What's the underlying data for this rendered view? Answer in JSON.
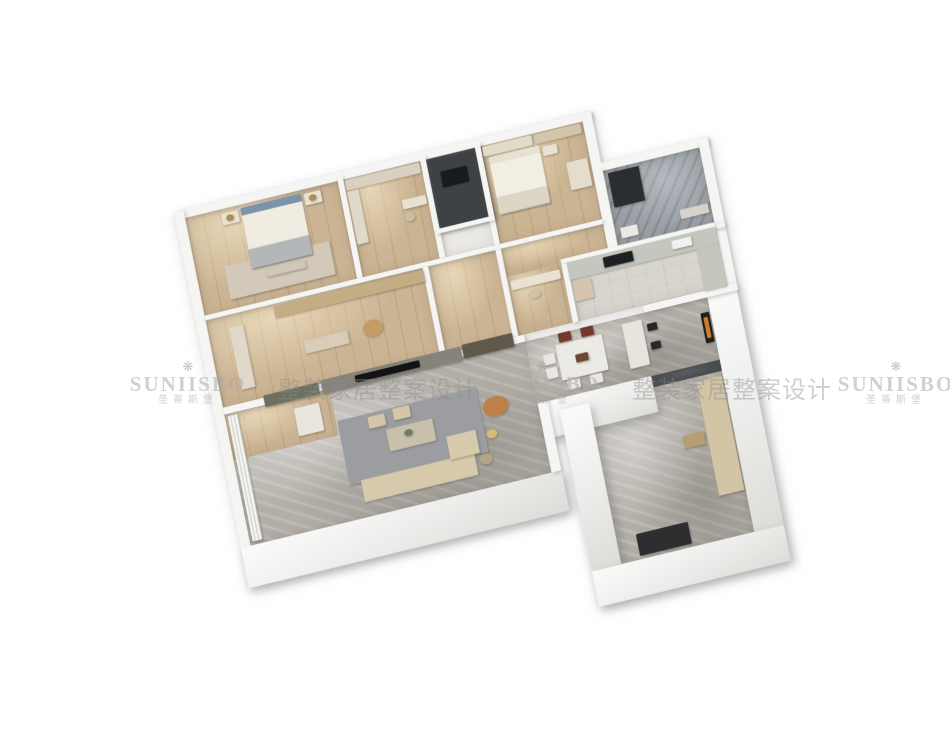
{
  "canvas": {
    "width": 950,
    "height": 733,
    "background": "#ffffff"
  },
  "watermark": {
    "flower_icon": "❋",
    "brand": "SUNIISBO",
    "brand_cn": "圣蒂斯堡",
    "tagline": "整装家居整案设计",
    "tiles": [
      {
        "x": 128,
        "y": 360
      },
      {
        "x": 482,
        "y": 360
      },
      {
        "x": 836,
        "y": 360
      }
    ]
  },
  "plan": {
    "floors": [
      {
        "id": "master-bedroom-floor",
        "x": 0,
        "y": 0,
        "w": 218,
        "h": 170,
        "tex": "wood"
      },
      {
        "id": "dressing-room-floor",
        "x": 226,
        "y": 0,
        "w": 110,
        "h": 170,
        "tex": "wood"
      },
      {
        "id": "utility-room-floor",
        "x": 344,
        "y": 0,
        "w": 70,
        "h": 120,
        "tex": "dark"
      },
      {
        "id": "utility-south-closet-floor",
        "x": 344,
        "y": 128,
        "w": 70,
        "h": 42,
        "tex": "plain"
      },
      {
        "id": "bedroom2-floor",
        "x": 422,
        "y": 0,
        "w": 146,
        "h": 170,
        "tex": "wood"
      },
      {
        "id": "bathroom-floor",
        "x": 582,
        "y": 90,
        "w": 138,
        "h": 134,
        "tex": "stone"
      },
      {
        "id": "study-floor",
        "x": 0,
        "y": 178,
        "w": 310,
        "h": 152,
        "tex": "wood"
      },
      {
        "id": "hallway-floor",
        "x": 318,
        "y": 178,
        "w": 104,
        "h": 152,
        "tex": "wood"
      },
      {
        "id": "hallway-east-floor",
        "x": 422,
        "y": 178,
        "w": 146,
        "h": 50,
        "tex": "wood"
      },
      {
        "id": "desk-nook-floor",
        "x": 422,
        "y": 228,
        "w": 78,
        "h": 102,
        "tex": "wood"
      },
      {
        "id": "kitchen-floor",
        "x": 508,
        "y": 228,
        "w": 212,
        "h": 102,
        "tex": "tile"
      },
      {
        "id": "living-room-floor",
        "x": 0,
        "y": 342,
        "w": 430,
        "h": 228,
        "tex": "marble"
      },
      {
        "id": "living-wood-corner-floor",
        "x": 0,
        "y": 342,
        "w": 150,
        "h": 80,
        "tex": "wood"
      },
      {
        "id": "dining-room-floor",
        "x": 430,
        "y": 342,
        "w": 260,
        "h": 108,
        "tex": "marble"
      },
      {
        "id": "passage-floor",
        "x": 590,
        "y": 450,
        "w": 100,
        "h": 20,
        "tex": "dark"
      },
      {
        "id": "entry-hall-floor",
        "x": 500,
        "y": 470,
        "w": 190,
        "h": 280,
        "tex": "marble"
      }
    ],
    "walls": [
      {
        "id": "wall-utility-backdrop",
        "x": 338,
        "y": -8,
        "w": 84,
        "h": 134,
        "kind": "darkwall"
      },
      {
        "id": "wall-north",
        "x": -14,
        "y": -14,
        "w": 596,
        "h": 14,
        "kind": "out"
      },
      {
        "id": "wall-west",
        "x": -14,
        "y": -14,
        "w": 14,
        "h": 598,
        "kind": "out"
      },
      {
        "id": "wall-south-living",
        "x": -14,
        "y": 570,
        "w": 458,
        "h": 70,
        "kind": "face"
      },
      {
        "id": "wall-bedroom2-east-step",
        "x": 568,
        "y": -14,
        "w": 14,
        "h": 100,
        "kind": "out"
      },
      {
        "id": "wall-bathroom-north",
        "x": 568,
        "y": 76,
        "w": 166,
        "h": 14,
        "kind": "out"
      },
      {
        "id": "wall-bathroom-east",
        "x": 720,
        "y": 76,
        "w": 14,
        "h": 162,
        "kind": "out"
      },
      {
        "id": "wall-kitchen-east",
        "x": 720,
        "y": 238,
        "w": 14,
        "h": 92,
        "kind": "out"
      },
      {
        "id": "wall-dining-east",
        "x": 690,
        "y": 330,
        "w": 42,
        "h": 420,
        "kind": "face"
      },
      {
        "id": "wall-dining-south",
        "x": 430,
        "y": 450,
        "w": 162,
        "h": 62,
        "kind": "face"
      },
      {
        "id": "wall-living-east",
        "x": 430,
        "y": 450,
        "w": 14,
        "h": 120,
        "kind": "out"
      },
      {
        "id": "wall-entry-west",
        "x": 458,
        "y": 470,
        "w": 42,
        "h": 280,
        "kind": "face"
      },
      {
        "id": "wall-entry-south",
        "x": 458,
        "y": 750,
        "w": 274,
        "h": 62,
        "kind": "face"
      },
      {
        "id": "wall-master-dressing",
        "x": 218,
        "y": -8,
        "w": 8,
        "h": 178,
        "kind": "in"
      },
      {
        "id": "wall-dressing-utility",
        "x": 336,
        "y": -8,
        "w": 8,
        "h": 178,
        "kind": "in"
      },
      {
        "id": "wall-utility-bedroom2",
        "x": 414,
        "y": -8,
        "w": 8,
        "h": 178,
        "kind": "in"
      },
      {
        "id": "wall-bedroom2-bath",
        "x": 568,
        "y": 86,
        "w": 14,
        "h": 146,
        "kind": "in"
      },
      {
        "id": "wall-topband-south",
        "x": 0,
        "y": 170,
        "w": 568,
        "h": 8,
        "kind": "in"
      },
      {
        "id": "wall-bathroom-south",
        "x": 568,
        "y": 224,
        "w": 166,
        "h": 8,
        "kind": "in"
      },
      {
        "id": "wall-study-east",
        "x": 310,
        "y": 178,
        "w": 8,
        "h": 152,
        "kind": "in"
      },
      {
        "id": "wall-nook-west",
        "x": 414,
        "y": 178,
        "w": 8,
        "h": 152,
        "kind": "in"
      },
      {
        "id": "wall-kitchen-north",
        "x": 500,
        "y": 220,
        "w": 220,
        "h": 8,
        "kind": "in"
      },
      {
        "id": "wall-nook-kitchen",
        "x": 500,
        "y": 228,
        "w": 8,
        "h": 102,
        "kind": "in"
      },
      {
        "id": "wall-tv",
        "x": 0,
        "y": 330,
        "w": 430,
        "h": 12,
        "kind": "in"
      },
      {
        "id": "wall-kitchen-south",
        "x": 600,
        "y": 330,
        "w": 134,
        "h": 12,
        "kind": "in"
      },
      {
        "id": "wall-utility-south",
        "x": 338,
        "y": 120,
        "w": 84,
        "h": 8,
        "kind": "in"
      }
    ],
    "furniture": [
      {
        "id": "master-rug",
        "x": 40,
        "y": 96,
        "w": 150,
        "h": 58,
        "c": "#d2c9b9"
      },
      {
        "id": "master-bed-headboard",
        "x": 78,
        "y": 6,
        "w": 86,
        "h": 13,
        "c": "#7b93ae"
      },
      {
        "id": "master-bed",
        "x": 78,
        "y": 19,
        "w": 86,
        "h": 92,
        "c": "#f0ece1"
      },
      {
        "id": "master-bed-throw",
        "x": 78,
        "y": 78,
        "w": 86,
        "h": 33,
        "c": "#b4b7ba"
      },
      {
        "id": "master-nightstand-left",
        "x": 50,
        "y": 8,
        "w": 24,
        "h": 20,
        "c": "#eae3d2"
      },
      {
        "id": "master-nightstand-right",
        "x": 168,
        "y": 8,
        "w": 24,
        "h": 20,
        "c": "#eae3d2"
      },
      {
        "id": "master-lamp-left",
        "x": 56,
        "y": 12,
        "w": 11,
        "h": 11,
        "c": "#b08d4f",
        "r": 1
      },
      {
        "id": "master-lamp-right",
        "x": 174,
        "y": 12,
        "w": 11,
        "h": 11,
        "c": "#b08d4f",
        "r": 1
      },
      {
        "id": "master-bench",
        "x": 96,
        "y": 118,
        "w": 56,
        "h": 13,
        "c": "#cfc8b8"
      },
      {
        "id": "dressing-closet-north",
        "x": 228,
        "y": 2,
        "w": 106,
        "h": 18,
        "c": "#d8d1c0"
      },
      {
        "id": "dressing-closet-west",
        "x": 228,
        "y": 22,
        "w": 16,
        "h": 92,
        "c": "#e0d9c8"
      },
      {
        "id": "dressing-vanity",
        "x": 300,
        "y": 58,
        "w": 34,
        "h": 16,
        "c": "#e8e1d1"
      },
      {
        "id": "dressing-stool",
        "x": 300,
        "y": 82,
        "w": 14,
        "h": 14,
        "c": "#cbbfa8",
        "r": 1
      },
      {
        "id": "utility-window-frame",
        "x": 360,
        "y": 26,
        "w": 38,
        "h": 28,
        "c": "#191b1d"
      },
      {
        "id": "bedroom2-wardrobe",
        "x": 424,
        "y": 2,
        "w": 70,
        "h": 17,
        "c": "#e2dbc9"
      },
      {
        "id": "bedroom2-bookshelf",
        "x": 498,
        "y": 2,
        "w": 66,
        "h": 17,
        "c": "#d2c5aa"
      },
      {
        "id": "bedroom2-headboard",
        "x": 430,
        "y": 22,
        "w": 72,
        "h": 12,
        "c": "#e7e1d2"
      },
      {
        "id": "bedroom2-bed",
        "x": 430,
        "y": 34,
        "w": 72,
        "h": 88,
        "c": "#f1eee4"
      },
      {
        "id": "bedroom2-throw",
        "x": 430,
        "y": 92,
        "w": 72,
        "h": 28,
        "c": "#dcd6c7"
      },
      {
        "id": "bedroom2-desk",
        "x": 534,
        "y": 62,
        "w": 30,
        "h": 48,
        "c": "#e4ddcb"
      },
      {
        "id": "bedroom2-nightstand",
        "x": 506,
        "y": 26,
        "w": 20,
        "h": 16,
        "c": "#eae3d3"
      },
      {
        "id": "bathroom-shower",
        "x": 588,
        "y": 96,
        "w": 44,
        "h": 60,
        "c": "#2b2e31"
      },
      {
        "id": "bathroom-vanity",
        "x": 676,
        "y": 186,
        "w": 40,
        "h": 16,
        "c": "#d7d3cb"
      },
      {
        "id": "bathroom-wc",
        "x": 590,
        "y": 192,
        "w": 24,
        "h": 18,
        "c": "#ebe9e5"
      },
      {
        "id": "study-wardrobe",
        "x": 30,
        "y": 200,
        "w": 20,
        "h": 108,
        "c": "#e0d9c9"
      },
      {
        "id": "study-bookshelf",
        "x": 96,
        "y": 182,
        "w": 214,
        "h": 20,
        "c": "#c3ad85"
      },
      {
        "id": "study-armchair",
        "x": 212,
        "y": 244,
        "w": 28,
        "h": 28,
        "c": "#c59b66",
        "r": 1
      },
      {
        "id": "study-desk",
        "x": 128,
        "y": 252,
        "w": 62,
        "h": 22,
        "c": "#d7cdb8"
      },
      {
        "id": "nook-desk",
        "x": 426,
        "y": 236,
        "w": 70,
        "h": 16,
        "c": "#e9e2d2"
      },
      {
        "id": "nook-chair",
        "x": 448,
        "y": 258,
        "w": 16,
        "h": 16,
        "c": "#cfc3ab",
        "r": 1
      },
      {
        "id": "kitchen-counter-north",
        "x": 508,
        "y": 228,
        "w": 212,
        "h": 30,
        "c": "#c3c7bd"
      },
      {
        "id": "kitchen-cooktop",
        "x": 558,
        "y": 234,
        "w": 42,
        "h": 18,
        "c": "#1e2022"
      },
      {
        "id": "kitchen-sink",
        "x": 656,
        "y": 234,
        "w": 28,
        "h": 15,
        "c": "#f0f1ef"
      },
      {
        "id": "kitchen-counter-east",
        "x": 688,
        "y": 258,
        "w": 32,
        "h": 72,
        "c": "#c3c7bd"
      },
      {
        "id": "kitchen-fridge",
        "x": 510,
        "y": 262,
        "w": 26,
        "h": 34,
        "c": "#d6c4ae"
      },
      {
        "id": "tv-marble-panel",
        "x": 140,
        "y": 324,
        "w": 200,
        "h": 24,
        "c": "#87837b"
      },
      {
        "id": "tv-screen",
        "x": 188,
        "y": 330,
        "w": 92,
        "h": 12,
        "c": "#111315"
      },
      {
        "id": "tv-cabinet-left",
        "x": 58,
        "y": 326,
        "w": 78,
        "h": 20,
        "c": "#6d7060"
      },
      {
        "id": "tv-shelf-right",
        "x": 342,
        "y": 322,
        "w": 72,
        "h": 24,
        "c": "#5f594c"
      },
      {
        "id": "living-curtain",
        "x": 4,
        "y": 346,
        "w": 14,
        "h": 218,
        "c": "",
        "tex": "curtain"
      },
      {
        "id": "living-rug",
        "x": 152,
        "y": 398,
        "w": 198,
        "h": 112,
        "c": "#9b9da0"
      },
      {
        "id": "living-sofa",
        "x": 168,
        "y": 506,
        "w": 162,
        "h": 38,
        "c": "#d6c9ac"
      },
      {
        "id": "living-chaise",
        "x": 296,
        "y": 468,
        "w": 42,
        "h": 40,
        "c": "#d6c9ac"
      },
      {
        "id": "living-coffee-table",
        "x": 216,
        "y": 432,
        "w": 66,
        "h": 38,
        "c": "#c9c0ab"
      },
      {
        "id": "living-table-plant",
        "x": 240,
        "y": 440,
        "w": 12,
        "h": 12,
        "c": "#6f7f5e",
        "r": 1
      },
      {
        "id": "living-ottoman-a",
        "x": 194,
        "y": 404,
        "w": 24,
        "h": 20,
        "c": "#d4c6a7"
      },
      {
        "id": "living-ottoman-b",
        "x": 230,
        "y": 400,
        "w": 24,
        "h": 20,
        "c": "#d4c6a7"
      },
      {
        "id": "living-leather-armchair",
        "x": 354,
        "y": 420,
        "w": 36,
        "h": 34,
        "c": "#bc8148",
        "r": 1
      },
      {
        "id": "living-floor-lamp",
        "x": 352,
        "y": 474,
        "w": 15,
        "h": 15,
        "c": "#d8b978",
        "r": 1
      },
      {
        "id": "living-side-table",
        "x": 336,
        "y": 512,
        "w": 18,
        "h": 18,
        "c": "#b5a586",
        "r": 1
      },
      {
        "id": "living-cabinet-nw",
        "x": 96,
        "y": 360,
        "w": 36,
        "h": 48,
        "c": "#e9e6de"
      },
      {
        "id": "dining-table",
        "x": 470,
        "y": 360,
        "w": 66,
        "h": 62,
        "c": "#eceae4"
      },
      {
        "id": "dining-table-decor",
        "x": 494,
        "y": 384,
        "w": 18,
        "h": 14,
        "c": "#6b4a33"
      },
      {
        "id": "dining-chair-1",
        "x": 476,
        "y": 342,
        "w": 18,
        "h": 16,
        "c": "#73392b"
      },
      {
        "id": "dining-chair-2",
        "x": 508,
        "y": 342,
        "w": 18,
        "h": 16,
        "c": "#73392b"
      },
      {
        "id": "dining-chair-3",
        "x": 476,
        "y": 424,
        "w": 18,
        "h": 16,
        "c": "#e9e7e1"
      },
      {
        "id": "dining-chair-4",
        "x": 508,
        "y": 424,
        "w": 18,
        "h": 16,
        "c": "#e9e7e1"
      },
      {
        "id": "dining-chair-5",
        "x": 450,
        "y": 372,
        "w": 16,
        "h": 18,
        "c": "#e9e7e1"
      },
      {
        "id": "dining-chair-6",
        "x": 450,
        "y": 396,
        "w": 16,
        "h": 18,
        "c": "#e9e7e1"
      },
      {
        "id": "dining-island",
        "x": 566,
        "y": 352,
        "w": 28,
        "h": 78,
        "c": "#e7e4dd"
      },
      {
        "id": "dining-stool-a",
        "x": 600,
        "y": 362,
        "w": 14,
        "h": 13,
        "c": "#26282a"
      },
      {
        "id": "dining-stool-b",
        "x": 600,
        "y": 394,
        "w": 14,
        "h": 13,
        "c": "#26282a"
      },
      {
        "id": "dining-art-frame",
        "x": 676,
        "y": 366,
        "w": 12,
        "h": 52,
        "c": "#1d1d1d"
      },
      {
        "id": "dining-art-canvas",
        "x": 679,
        "y": 374,
        "w": 6,
        "h": 36,
        "c": "#cf7c2c"
      },
      {
        "id": "entry-shoe-cabinets",
        "x": 652,
        "y": 478,
        "w": 36,
        "h": 198,
        "c": "#d3c4a6"
      },
      {
        "id": "entry-console",
        "x": 618,
        "y": 562,
        "w": 30,
        "h": 22,
        "c": "#b89e74"
      },
      {
        "id": "entry-door-mat",
        "x": 528,
        "y": 706,
        "w": 74,
        "h": 38,
        "c": "#2d2e30"
      }
    ]
  }
}
